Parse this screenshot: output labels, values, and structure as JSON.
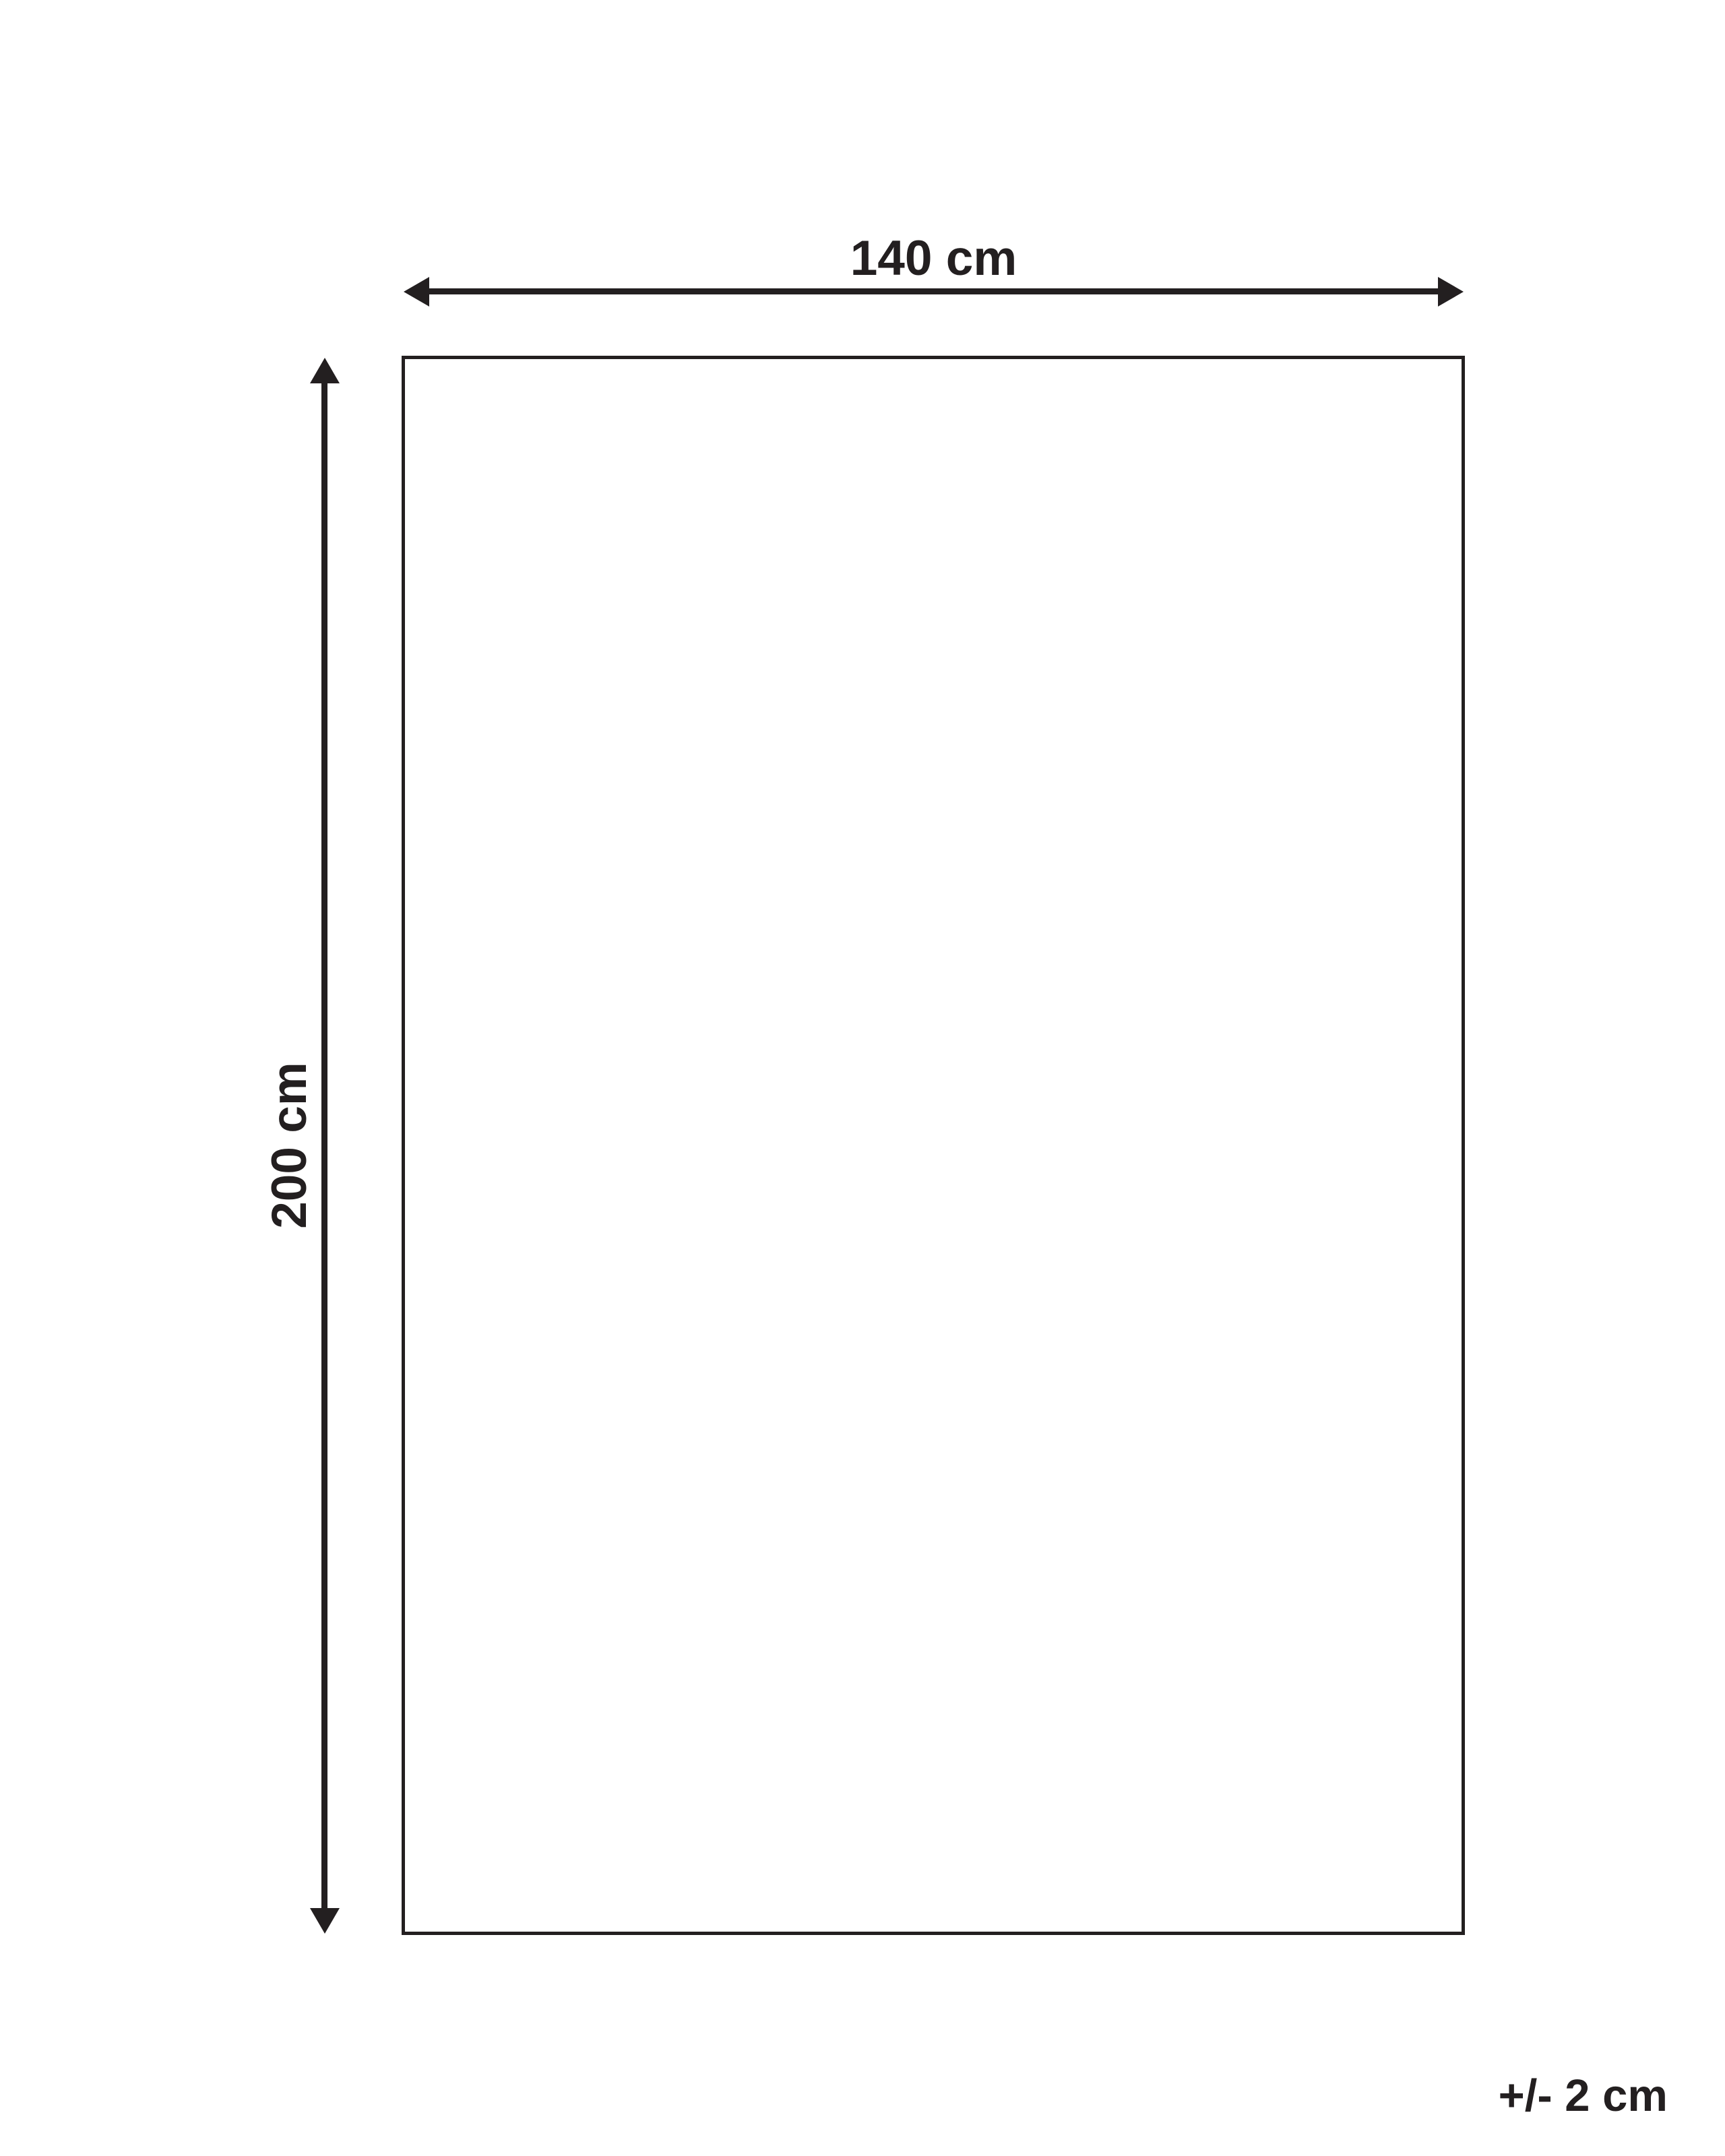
{
  "diagram": {
    "width_label": "140 cm",
    "height_label": "200 cm",
    "tolerance_label": "+/- 2 cm"
  },
  "colors": {
    "ink": "#231f20",
    "background": "#ffffff"
  }
}
